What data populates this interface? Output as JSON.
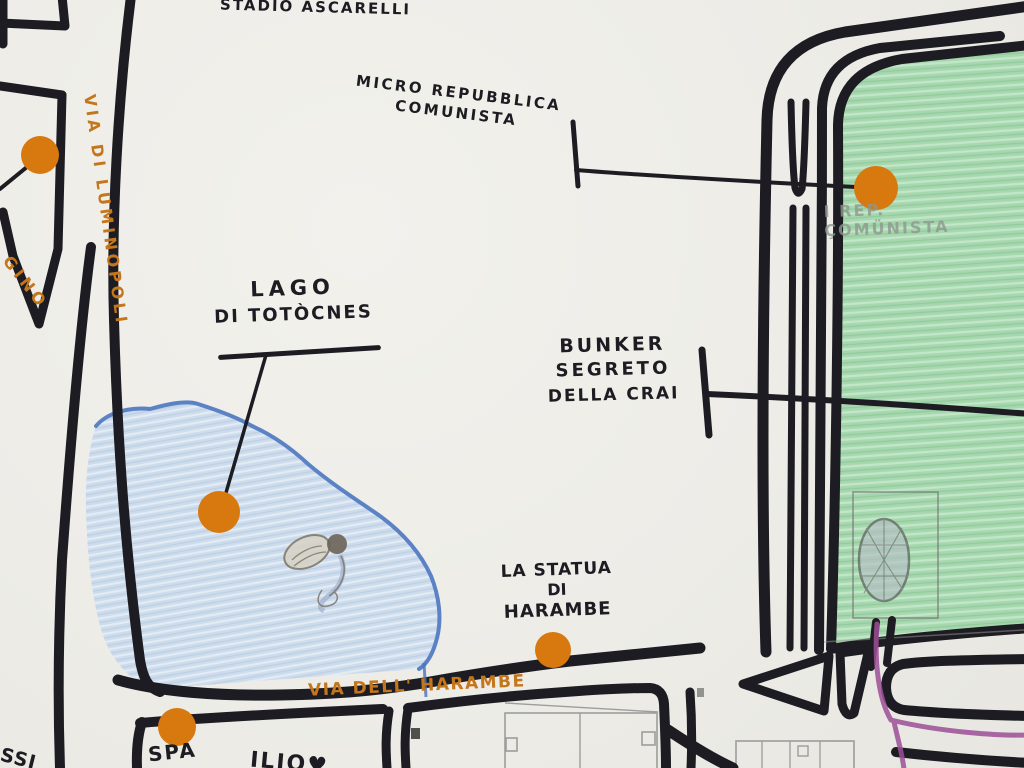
{
  "map": {
    "labels": {
      "stadium": "STADIO ASCARELLI",
      "micro_republic": {
        "line1": "MICRO REPUBBLICA",
        "line2": "COMUNISTA"
      },
      "lake": {
        "line1": "LAGO",
        "line2": "DI TOTÒCNES"
      },
      "bunker": {
        "line1": "BUNKER",
        "line2": "SEGRETO",
        "line3": "DELLA CRAI"
      },
      "statue": {
        "line1": "LA STATUA",
        "line2": "DI",
        "line3": "HARAMBE"
      },
      "street_harambe": "VIA DELL' HARAMBE",
      "street_luminopoli": "VIA DI LUMINOPOLI",
      "street_fragment": "GINO",
      "spa": "SPA",
      "text_fragment_bottom": "ILIO♥",
      "text_fragment_corner": "SSI",
      "pencil_note": {
        "line1": "I REP.",
        "line2": "ÇOMÜNISTA"
      }
    },
    "markers": [
      {
        "id": "via-di-luminopoli",
        "x": 40,
        "y": 155,
        "r": 19
      },
      {
        "id": "lago-di-totocnes",
        "x": 219,
        "y": 512,
        "r": 21
      },
      {
        "id": "statua-di-harambe",
        "x": 553,
        "y": 650,
        "r": 18
      },
      {
        "id": "spa",
        "x": 177,
        "y": 727,
        "r": 19
      },
      {
        "id": "micro-repubblica-comunista",
        "x": 876,
        "y": 188,
        "r": 22
      }
    ],
    "colors": {
      "paper": "#edece7",
      "ink": "#1c1c22",
      "street_text": "#c4761c",
      "marker_dot": "#d8790f",
      "lake_fill": "#cddced",
      "lake_outline": "#5b82c4",
      "park_fill": "#a6d7ae",
      "purple_road": "#9c4f96",
      "pencil": "#8f988f"
    }
  }
}
